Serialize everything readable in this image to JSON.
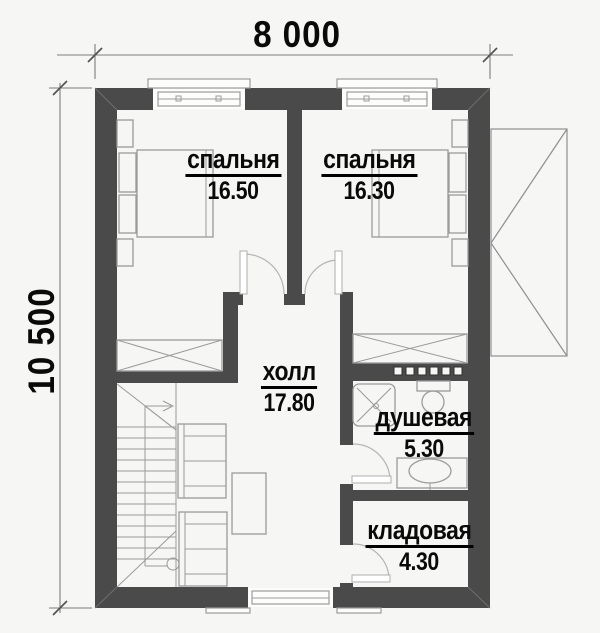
{
  "plan": {
    "title": "second-floor-plan",
    "dimensions": {
      "width": "8 000",
      "height": "10 500"
    },
    "rooms": [
      {
        "id": "bedroom-1",
        "name": "спальня",
        "area": "16.50"
      },
      {
        "id": "bedroom-2",
        "name": "спальня",
        "area": "16.30"
      },
      {
        "id": "hall",
        "name": "холл",
        "area": "17.80"
      },
      {
        "id": "shower",
        "name": "душевая",
        "area": "5.30"
      },
      {
        "id": "storage",
        "name": "кладовая",
        "area": "4.30"
      }
    ],
    "theme": {
      "wall_color": "#4a4a4a",
      "furniture_line": "#9b9b9b",
      "dim_line": "#7d7d7d",
      "text_color": "#0a0a0a",
      "bg_color": "#f6f6f4"
    }
  }
}
